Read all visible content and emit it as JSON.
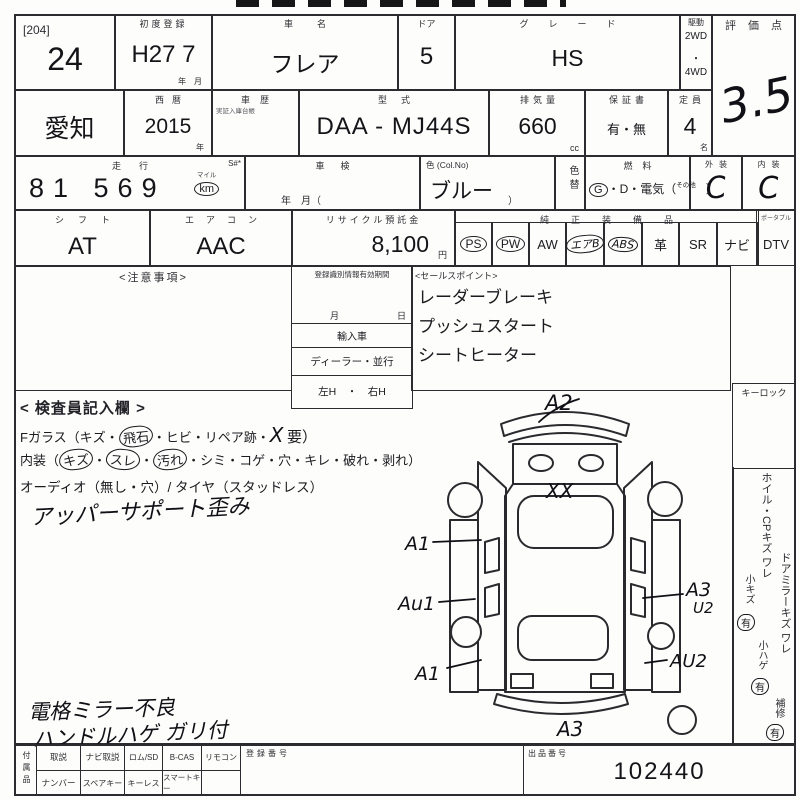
{
  "colors": {
    "ink": "#2b2b30",
    "hand": "#101016",
    "paper": "#fdfdfb"
  },
  "lot": {
    "tag": "[204]",
    "number": "24"
  },
  "row1": {
    "first_reg_label": "初度登録",
    "first_reg": "H27 7",
    "first_reg_unit": "年　月",
    "name_label": "車名",
    "name": "フレア",
    "door_label": "ドア",
    "door": "5",
    "grade_label": "グレード",
    "grade": "HS",
    "drive_label": "駆動",
    "drive_1": "2WD",
    "drive_dot": "・",
    "drive_2": "4WD",
    "score_label": "評価点",
    "score": "3.5"
  },
  "row2": {
    "pref": "愛知",
    "year_label": "西暦",
    "year": "2015",
    "year_unit": "年",
    "history_label": "車歴",
    "history_note": "実証入庫台帳",
    "model_label": "型式",
    "model": "DAA - MJ44S",
    "disp_label": "排気量",
    "disp": "660",
    "disp_unit": "cc",
    "warranty_label": "保証書",
    "warranty": "有・無",
    "cap_label": "定員",
    "cap": "4",
    "cap_unit": "名"
  },
  "row3": {
    "mileage_label": "走行",
    "mileage_s": "S#*",
    "mileage": "81 569",
    "mile_top": "マイル",
    "mile_unit": "km",
    "shaken_label": "車検",
    "shaken_note": "年　月（",
    "color_label": "色 (Col.No)",
    "color": "ブルー",
    "color_paren": "）",
    "color_change": "色替",
    "fuel_label": "燃料",
    "fuel_g": "G",
    "fuel_rest": "・D・電気（",
    "fuel_other": "その他",
    "fuel_close": "）",
    "ext_label": "外装",
    "ext": "C",
    "int_label": "内装",
    "int": "C"
  },
  "row4": {
    "shift_label": "シフト",
    "shift": "AT",
    "ac_label": "エアコン",
    "ac": "AAC",
    "recycle_label": "リサイクル預託金",
    "recycle": "8,100",
    "recycle_unit": "円",
    "equip_label": "純正装備品",
    "equip": [
      {
        "t": "PS"
      },
      {
        "t": "PW"
      },
      {
        "t": "AW"
      },
      {
        "t": "エアB"
      },
      {
        "t": "ABS"
      },
      {
        "t": "革"
      },
      {
        "t": "SR"
      },
      {
        "t": "ナビ"
      }
    ],
    "dtv_head": "ポータブル",
    "dtv": "DTV"
  },
  "middle": {
    "notes_title": "<注意事項>",
    "reg_title": "登録識別情報有効期間",
    "reg_month": "月",
    "reg_day": "日",
    "reg_import": "輸入車",
    "reg_dealer": "ディーラー・並行",
    "reg_handle": "左H　・　右H",
    "sales_title": "<セールスポイント>",
    "sales_lines": [
      "レーダーブレーキ",
      "プッシュスタート",
      "シートヒーター"
    ]
  },
  "inspector": {
    "title": "< 検査員記入欄 >",
    "glass_a": "Fガラス（キズ・",
    "glass_c": "飛石",
    "glass_b": "・ヒビ・リペア跡・",
    "glass_x": "X",
    "glass_d": "要）",
    "int_a": "内装（",
    "int_c1": "キズ",
    "int_s1": "・",
    "int_c2": "スレ",
    "int_s2": "・",
    "int_c3": "汚れ",
    "int_b": "・シミ・コゲ・穴・キレ・破れ・剥れ）",
    "audio": "オーディオ（無し・穴）/ タイヤ（スタッドレス）",
    "note": "アッパーサポート歪み"
  },
  "hand_notes": {
    "line1": "電格ミラー不良",
    "line2": "ハンドルハゲ ガリ付"
  },
  "right_col": {
    "keylock": "キーロック",
    "wheel": "ホイル・CPキズ ワレ",
    "wheel_small": "小キズ",
    "wheel_yes": "有",
    "mirror": "ドアミラーキズ ワレ",
    "mirror_small": "小ハゲ",
    "mirror_yes": "有",
    "repair": "補修",
    "repair_yes": "有"
  },
  "diagram": {
    "a2": "A2",
    "xx": "XX",
    "a1_front": "A1",
    "au1": "Au1",
    "a1_rear": "A1",
    "a3_bottom": "A3",
    "a3_right": "A3",
    "u2_right": "U2",
    "au2": "AU2"
  },
  "bottom": {
    "side_label": "付属品",
    "row1": [
      "取説",
      "ナビ取説",
      "ロム/SD",
      "B-CAS",
      "リモコン"
    ],
    "row2": [
      "ナンバー",
      "スペアキー",
      "キーレス",
      "スマートキー"
    ],
    "reg_label": "登録番号",
    "lot_label": "出品番号",
    "lot_no": "102440"
  }
}
